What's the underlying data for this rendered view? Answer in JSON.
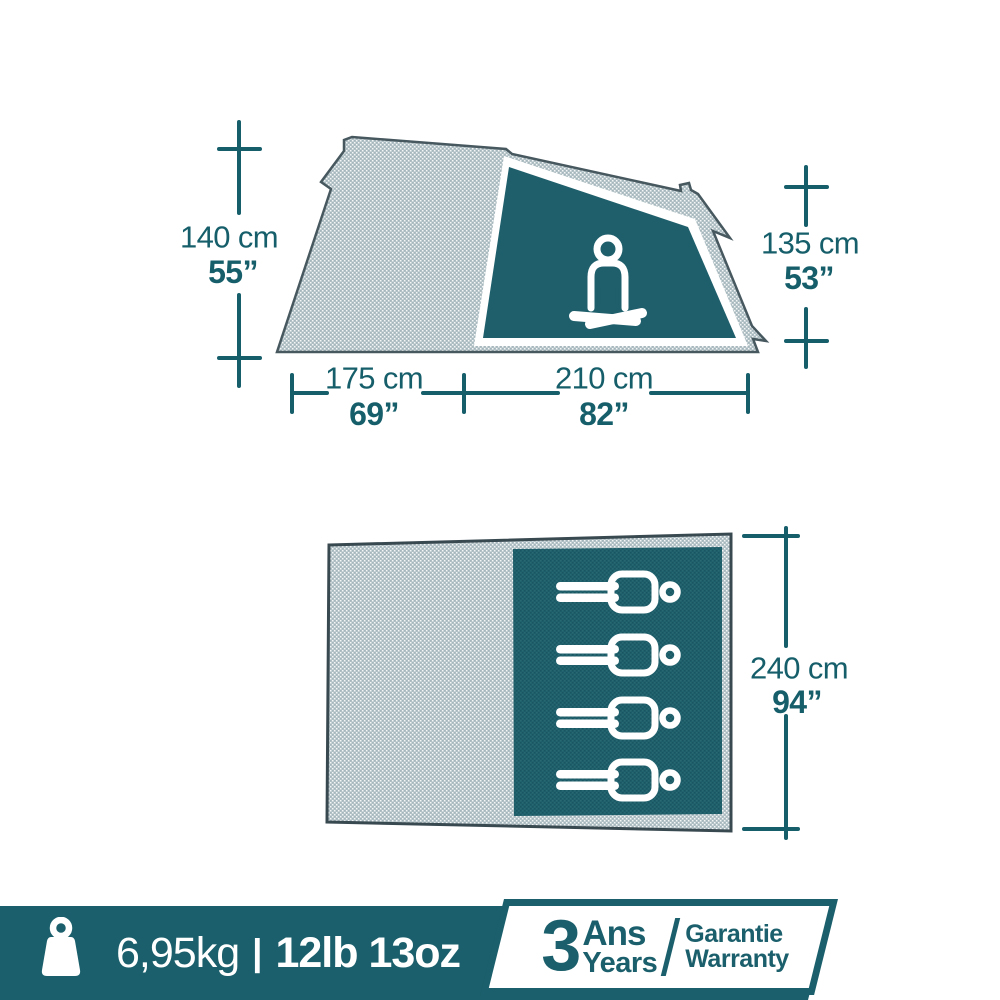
{
  "colors": {
    "teal_text": "#155e6a",
    "teal_band": "#1a5f6b",
    "dark_panel": "#1e5f6b",
    "fabric": "#b5c4c8",
    "outline": "#47585f",
    "white": "#ffffff"
  },
  "side_view": {
    "description": "tent side profile with seated person pictogram",
    "height_left_cm": "140 cm",
    "height_left_in": "55”",
    "height_right_cm": "135 cm",
    "height_right_in": "53”",
    "width_front_cm": "175 cm",
    "width_front_in": "69”",
    "width_door_cm": "210 cm",
    "width_door_in": "82”"
  },
  "floor_plan": {
    "description": "tent floor plan with sleeping area",
    "length_cm": "240 cm",
    "length_in": "94”",
    "sleeper_count": 4
  },
  "footer": {
    "weight_metric": "6,95kg",
    "separator": "|",
    "weight_imperial": "12lb 13oz",
    "warranty": {
      "number": "3",
      "unit_fr": "Ans",
      "unit_en": "Years",
      "label_fr": "Garantie",
      "label_en": "Warranty"
    }
  }
}
